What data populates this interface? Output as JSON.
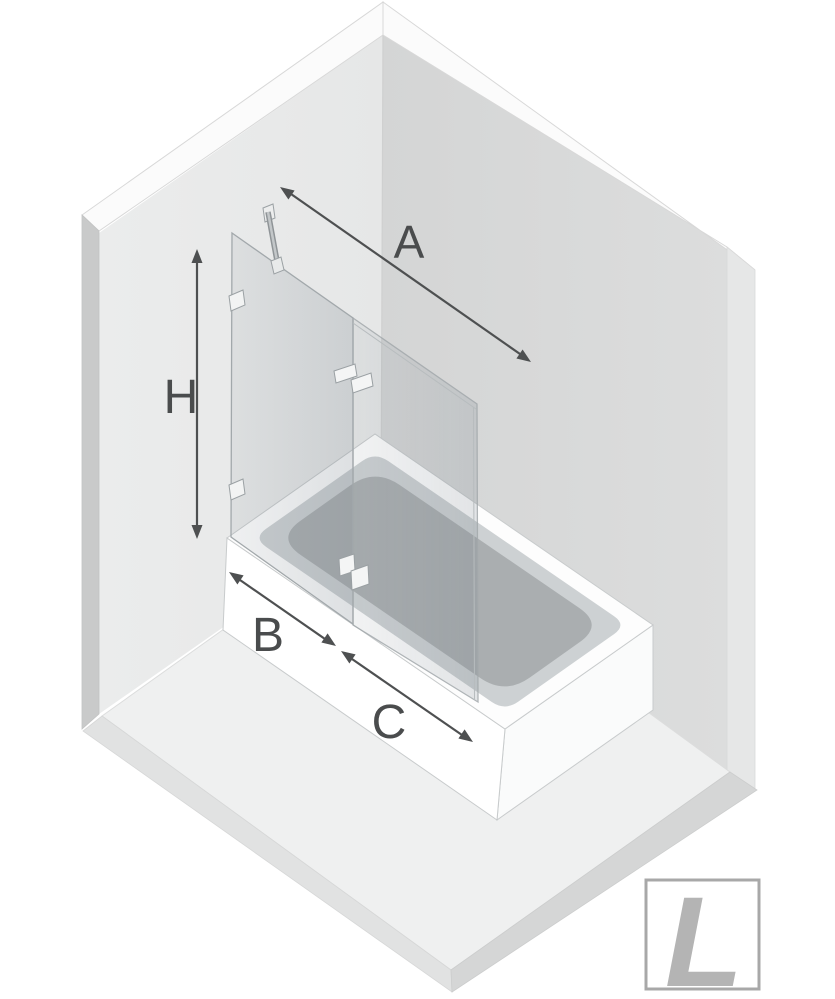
{
  "diagram": {
    "type": "isometric-installation-diagram",
    "subject": "folding glass bath screen mounted on a bathtub in a room corner",
    "dimensions": [
      {
        "label": "A"
      },
      {
        "label": "H"
      },
      {
        "label": "B"
      },
      {
        "label": "C"
      }
    ],
    "badge": {
      "label": "L"
    },
    "colors": {
      "background": "#ffffff",
      "left_wall": "#e9eaea",
      "right_wall": "#d9dada",
      "wall_trim": "#fbfbfb",
      "left_wall_side": "#c9caca",
      "right_wall_side": "#e6e7e7",
      "floor": "#eff0f0",
      "floor_edge_left": "#e1e2e2",
      "floor_edge_right": "#d5d6d6",
      "tub_front": "#ffffff",
      "tub_end": "#fafbfb",
      "tub_inner_band": "#cdd1d3",
      "basin": "#aaaeb0",
      "glass_stroke": "#a2a8ab",
      "hardware": "#f2f3f3",
      "dimension_line": "#4e5051",
      "label_text": "#4a4c4d",
      "badge_border": "#a8a8a8",
      "badge_letter": "#b4b4b4"
    }
  }
}
